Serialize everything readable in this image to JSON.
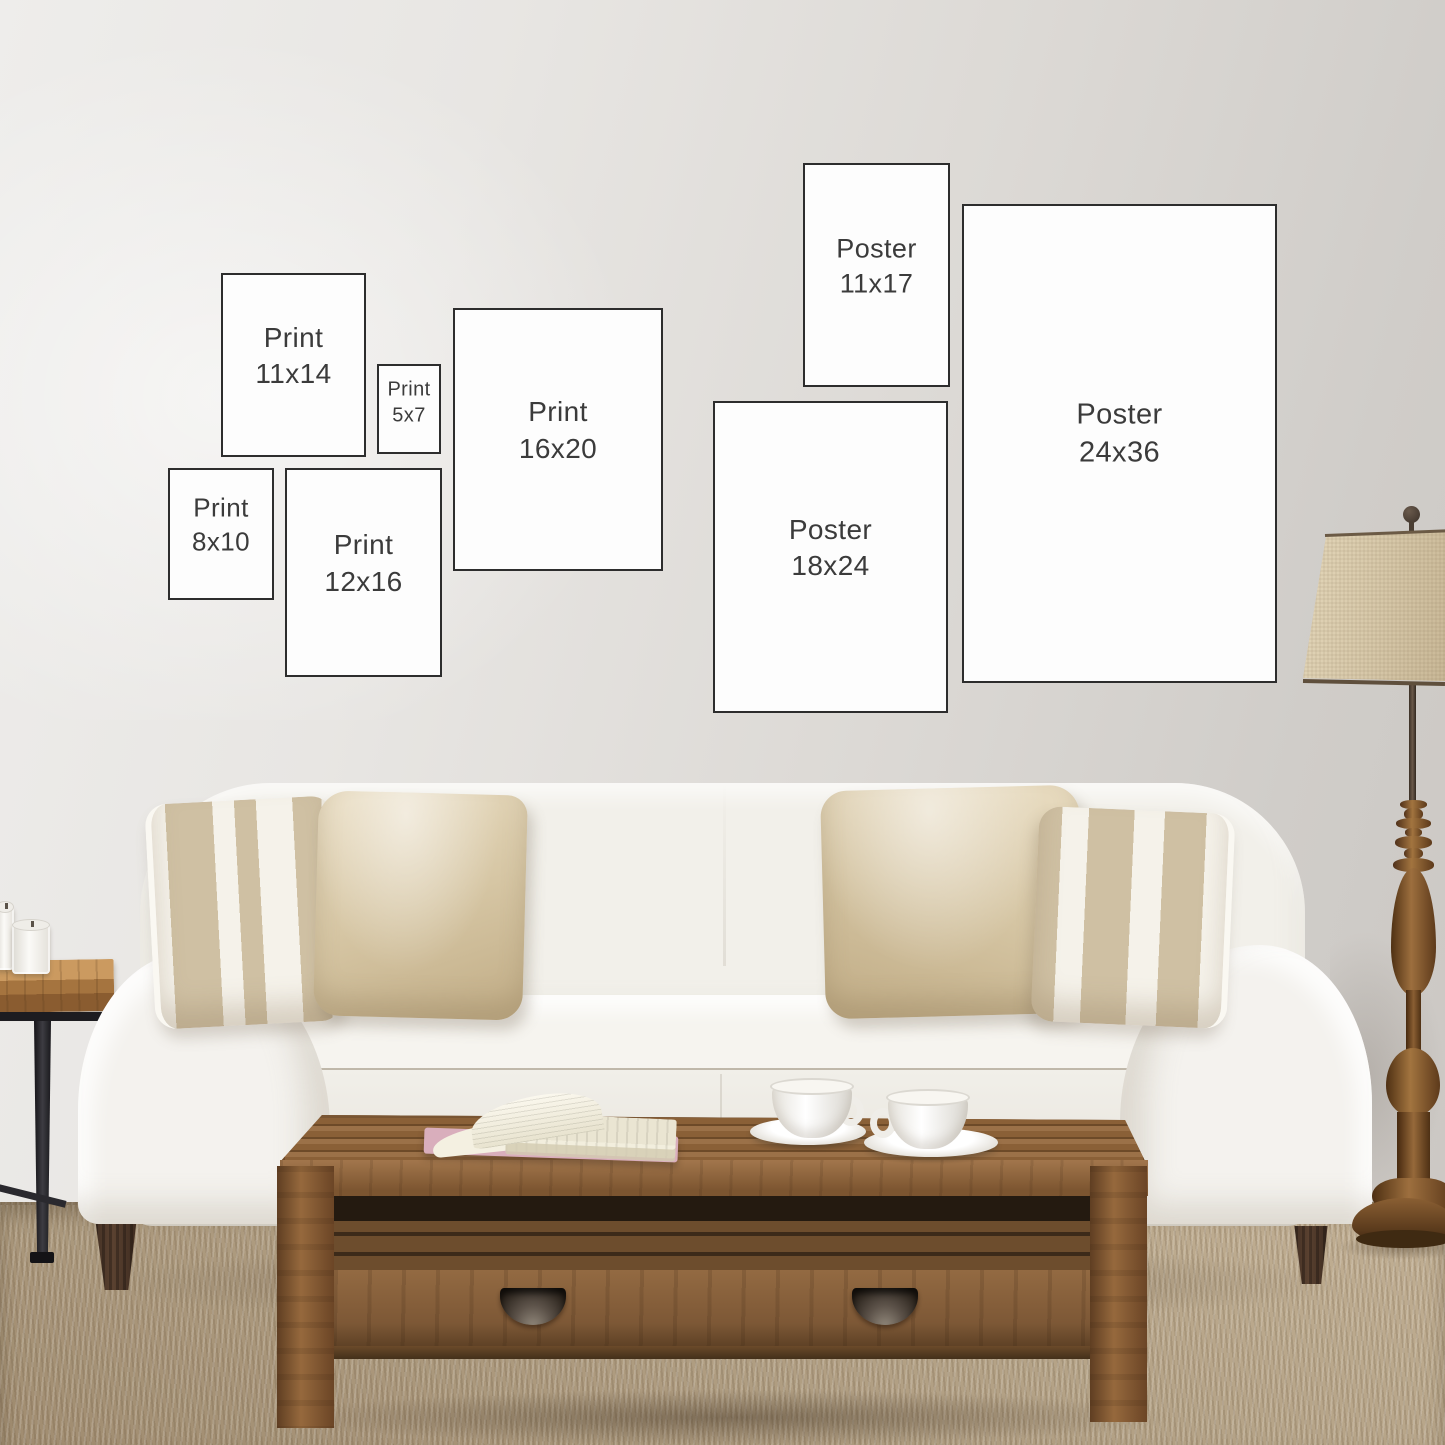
{
  "colors": {
    "wall_left": "#ecebe8",
    "wall_right": "#cfccc8",
    "frame_fill": "#fdfdfd",
    "frame_border": "#2d2d2d",
    "label_text": "#3b3b3b",
    "sofa": "#f2f0ea",
    "pillow_linen": "#d5c5a4",
    "pillow_stripe": "#cfc1a6",
    "wood_table": "#8a6037",
    "wood_lamp": "#96683a",
    "rug": "#b3a185",
    "metal_legs": "#27262a"
  },
  "size_boxes": [
    {
      "label_line1": "Print",
      "label_line2": "11x14",
      "x": 221,
      "y": 273,
      "w": 145,
      "h": 184,
      "fs": 28
    },
    {
      "label_line1": "Print",
      "label_line2": "5x7",
      "x": 377,
      "y": 364,
      "w": 64,
      "h": 90,
      "fs": 20
    },
    {
      "label_line1": "Print",
      "label_line2": "16x20",
      "x": 453,
      "y": 308,
      "w": 210,
      "h": 263,
      "fs": 28
    },
    {
      "label_line1": "Print",
      "label_line2": "8x10",
      "x": 168,
      "y": 468,
      "w": 106,
      "h": 132,
      "fs": 26
    },
    {
      "label_line1": "Print",
      "label_line2": "12x16",
      "x": 285,
      "y": 468,
      "w": 157,
      "h": 209,
      "fs": 28
    },
    {
      "label_line1": "Poster",
      "label_line2": "11x17",
      "x": 803,
      "y": 163,
      "w": 147,
      "h": 224,
      "fs": 27
    },
    {
      "label_line1": "Poster",
      "label_line2": "18x24",
      "x": 713,
      "y": 401,
      "w": 235,
      "h": 312,
      "fs": 28
    },
    {
      "label_line1": "Poster",
      "label_line2": "24x36",
      "x": 962,
      "y": 204,
      "w": 315,
      "h": 479,
      "fs": 29
    }
  ],
  "scene_objects": [
    "wall",
    "jute-rug",
    "sofa",
    "striped-pillow",
    "linen-pillow",
    "coffee-table",
    "open-book",
    "teacup",
    "floor-lamp",
    "side-table",
    "candle"
  ]
}
